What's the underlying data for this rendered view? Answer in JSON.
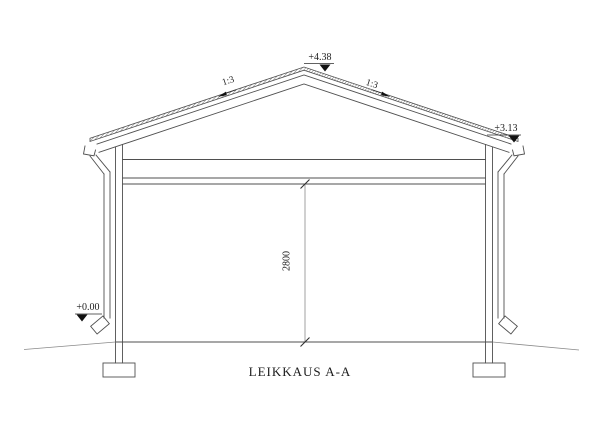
{
  "drawing": {
    "title": "LEIKKAUS A-A",
    "labels": {
      "ridge_elevation": "+4.38",
      "eave_elevation_right": "+3.13",
      "ground_elevation_left": "+0.00",
      "roof_slope_left": "1:3",
      "roof_slope_right": "1:3",
      "interior_height": "2800"
    },
    "colors": {
      "line": "#4f4f4f",
      "thin_line": "#8a8a8a",
      "marker": "#111111",
      "text": "#1c1c1c",
      "background": "#ffffff"
    }
  }
}
